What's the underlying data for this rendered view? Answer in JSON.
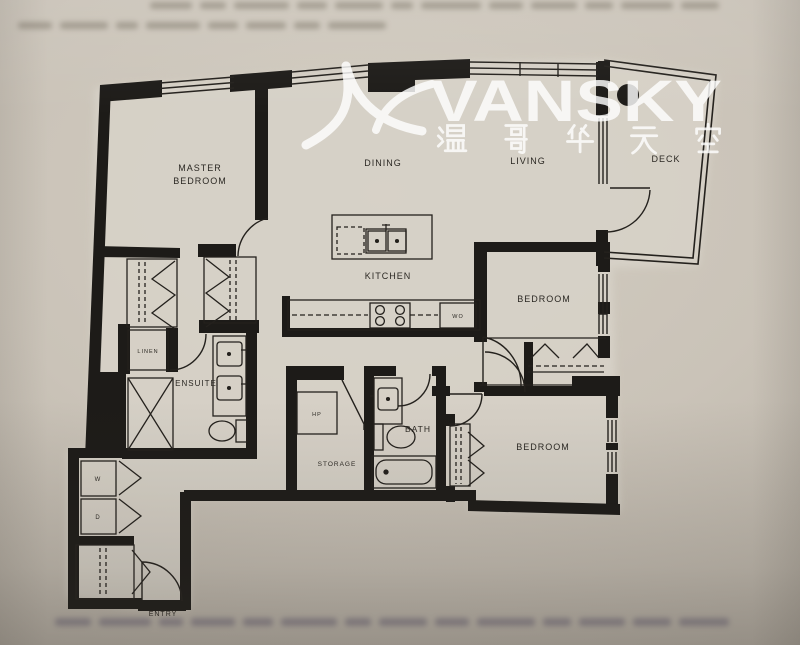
{
  "watermark": {
    "brand": "VANSKY",
    "chinese": "温哥华天空",
    "logo": "seagull-swoosh-icon",
    "color": "#ffffff"
  },
  "floorplan": {
    "rooms": {
      "master_bedroom": {
        "line1": "MASTER",
        "line2": "BEDROOM"
      },
      "dining": "DINING",
      "living": "LIVING",
      "deck": "DECK",
      "kitchen": "KITCHEN",
      "bedroom_mid": "BEDROOM",
      "bedroom_lower": "BEDROOM",
      "ensuite": "ENSUITE",
      "bath": "BATH",
      "storage": "STORAGE",
      "linen": "LINEN",
      "entry": "ENTRY"
    },
    "appliances": {
      "washer": "W",
      "dryer": "D",
      "heat_pump": "HP",
      "wall_oven": "WO"
    }
  },
  "colors": {
    "ink": "#1d1b18",
    "paper": "#c7c0b5",
    "watermark_opacity": "0.8"
  }
}
